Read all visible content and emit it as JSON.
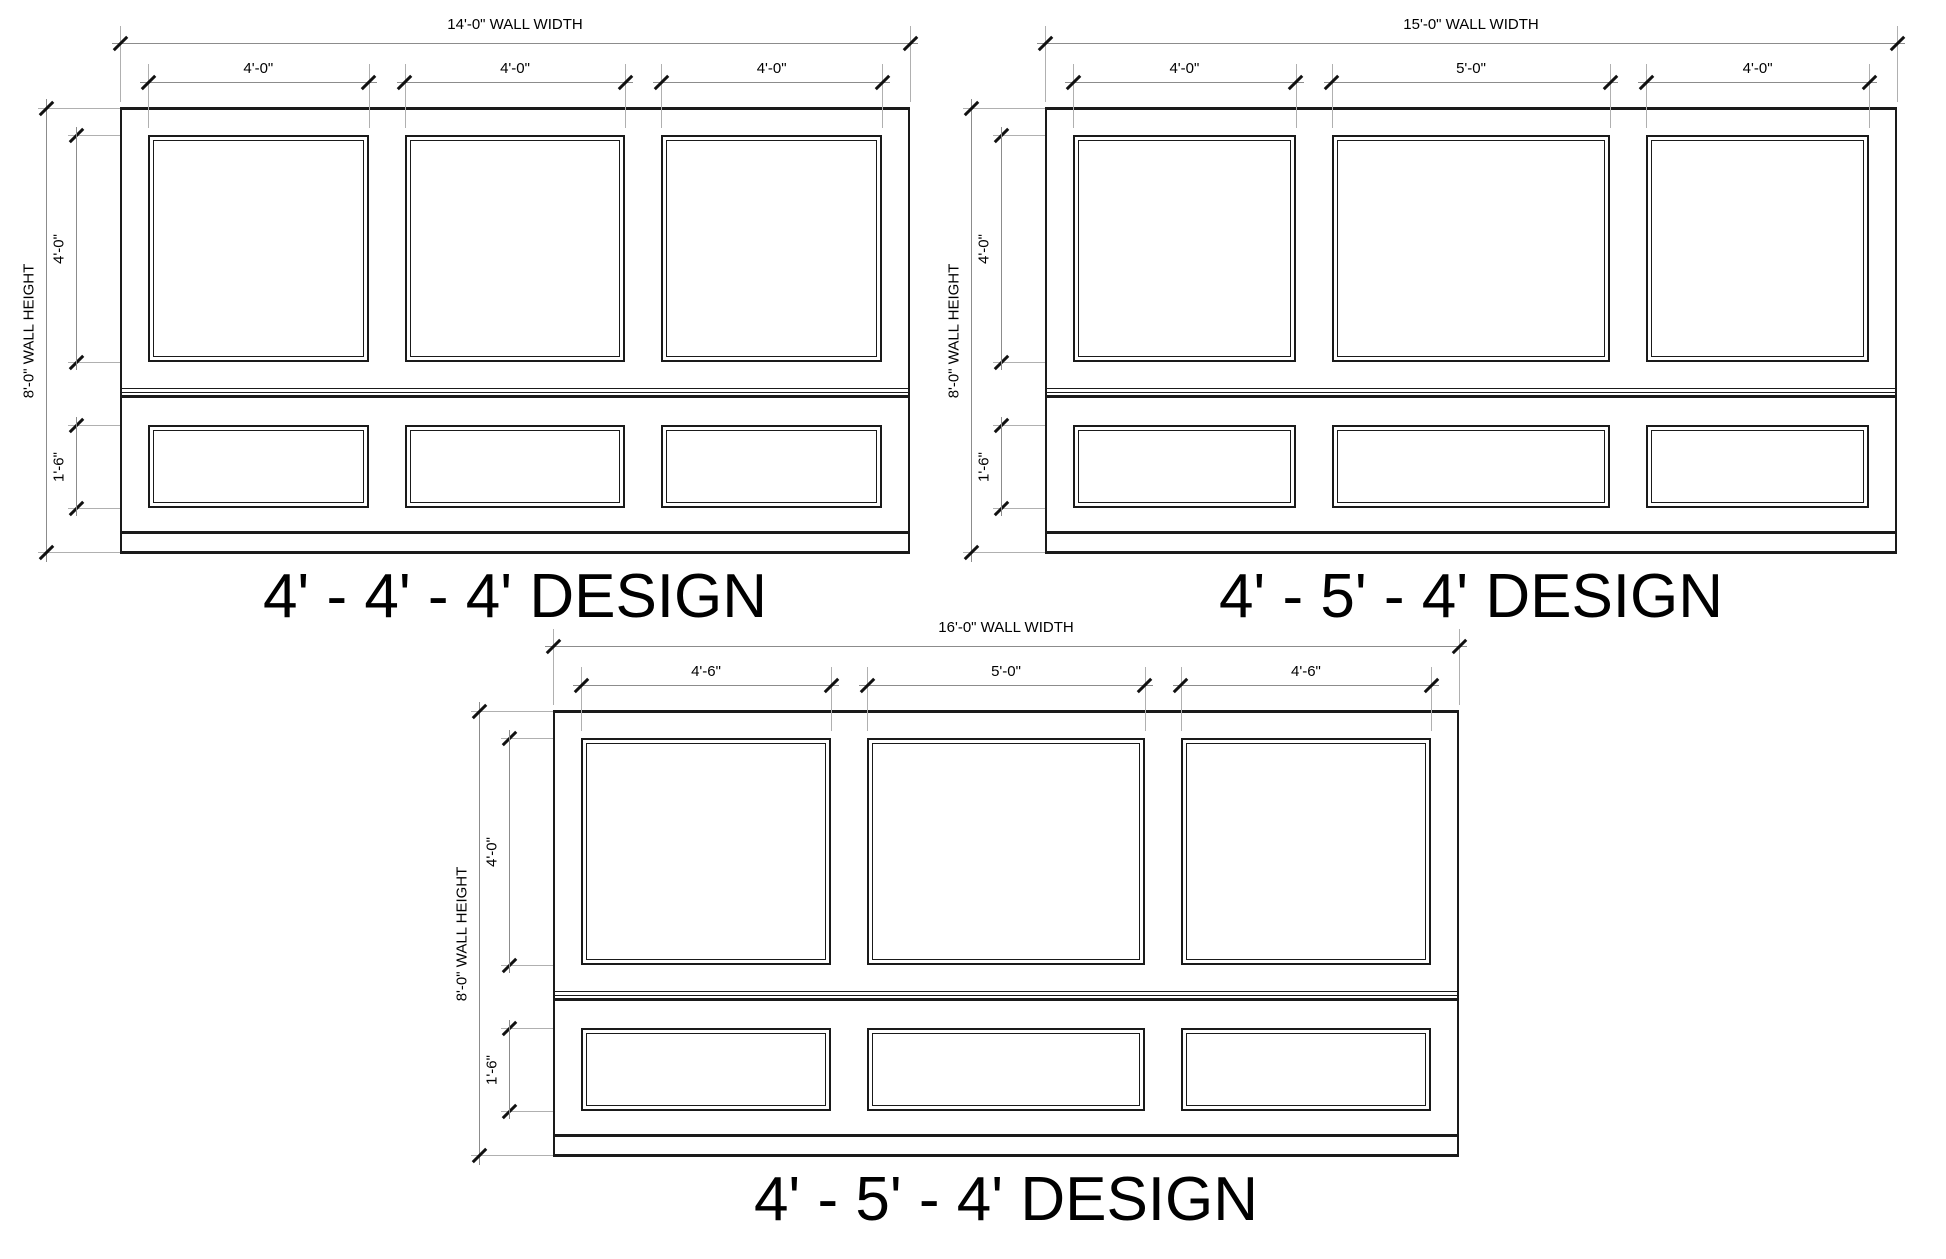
{
  "sheet": {
    "background_color": "#ffffff",
    "line_color": "#1a1a1a",
    "dim_line_color": "#8c8c8c",
    "extension_line_color": "#b0b0b0",
    "tick_color": "#111111",
    "text_color": "#000000"
  },
  "drawings": [
    {
      "id": "top-left",
      "title": "4' - 4' - 4' DESIGN",
      "wall_width_label": "14'-0\" WALL WIDTH",
      "wall_width_feet": 14,
      "wall_height_label": "8'-0\" WALL HEIGHT",
      "upper_panel_height_label": "4'-0\"",
      "lower_panel_height_label": "1'-6\"",
      "panel_width_labels": [
        "4'-0\"",
        "4'-0\"",
        "4'-0\""
      ],
      "panel_width_feet": [
        4,
        4,
        4
      ]
    },
    {
      "id": "top-right",
      "title": "4' - 5' - 4' DESIGN",
      "wall_width_label": "15'-0\" WALL WIDTH",
      "wall_width_feet": 15,
      "wall_height_label": "8'-0\" WALL HEIGHT",
      "upper_panel_height_label": "4'-0\"",
      "lower_panel_height_label": "1'-6\"",
      "panel_width_labels": [
        "4'-0\"",
        "5'-0\"",
        "4'-0\""
      ],
      "panel_width_feet": [
        4,
        5,
        4
      ]
    },
    {
      "id": "bottom",
      "title": "4' - 5' - 4' DESIGN",
      "wall_width_label": "16'-0\" WALL WIDTH",
      "wall_width_feet": 16,
      "wall_height_label": "8'-0\" WALL HEIGHT",
      "upper_panel_height_label": "4'-0\"",
      "lower_panel_height_label": "1'-6\"",
      "panel_width_labels": [
        "4'-6\"",
        "5'-0\"",
        "4'-6\""
      ],
      "panel_width_feet": [
        4.5,
        5,
        4.5
      ]
    }
  ]
}
